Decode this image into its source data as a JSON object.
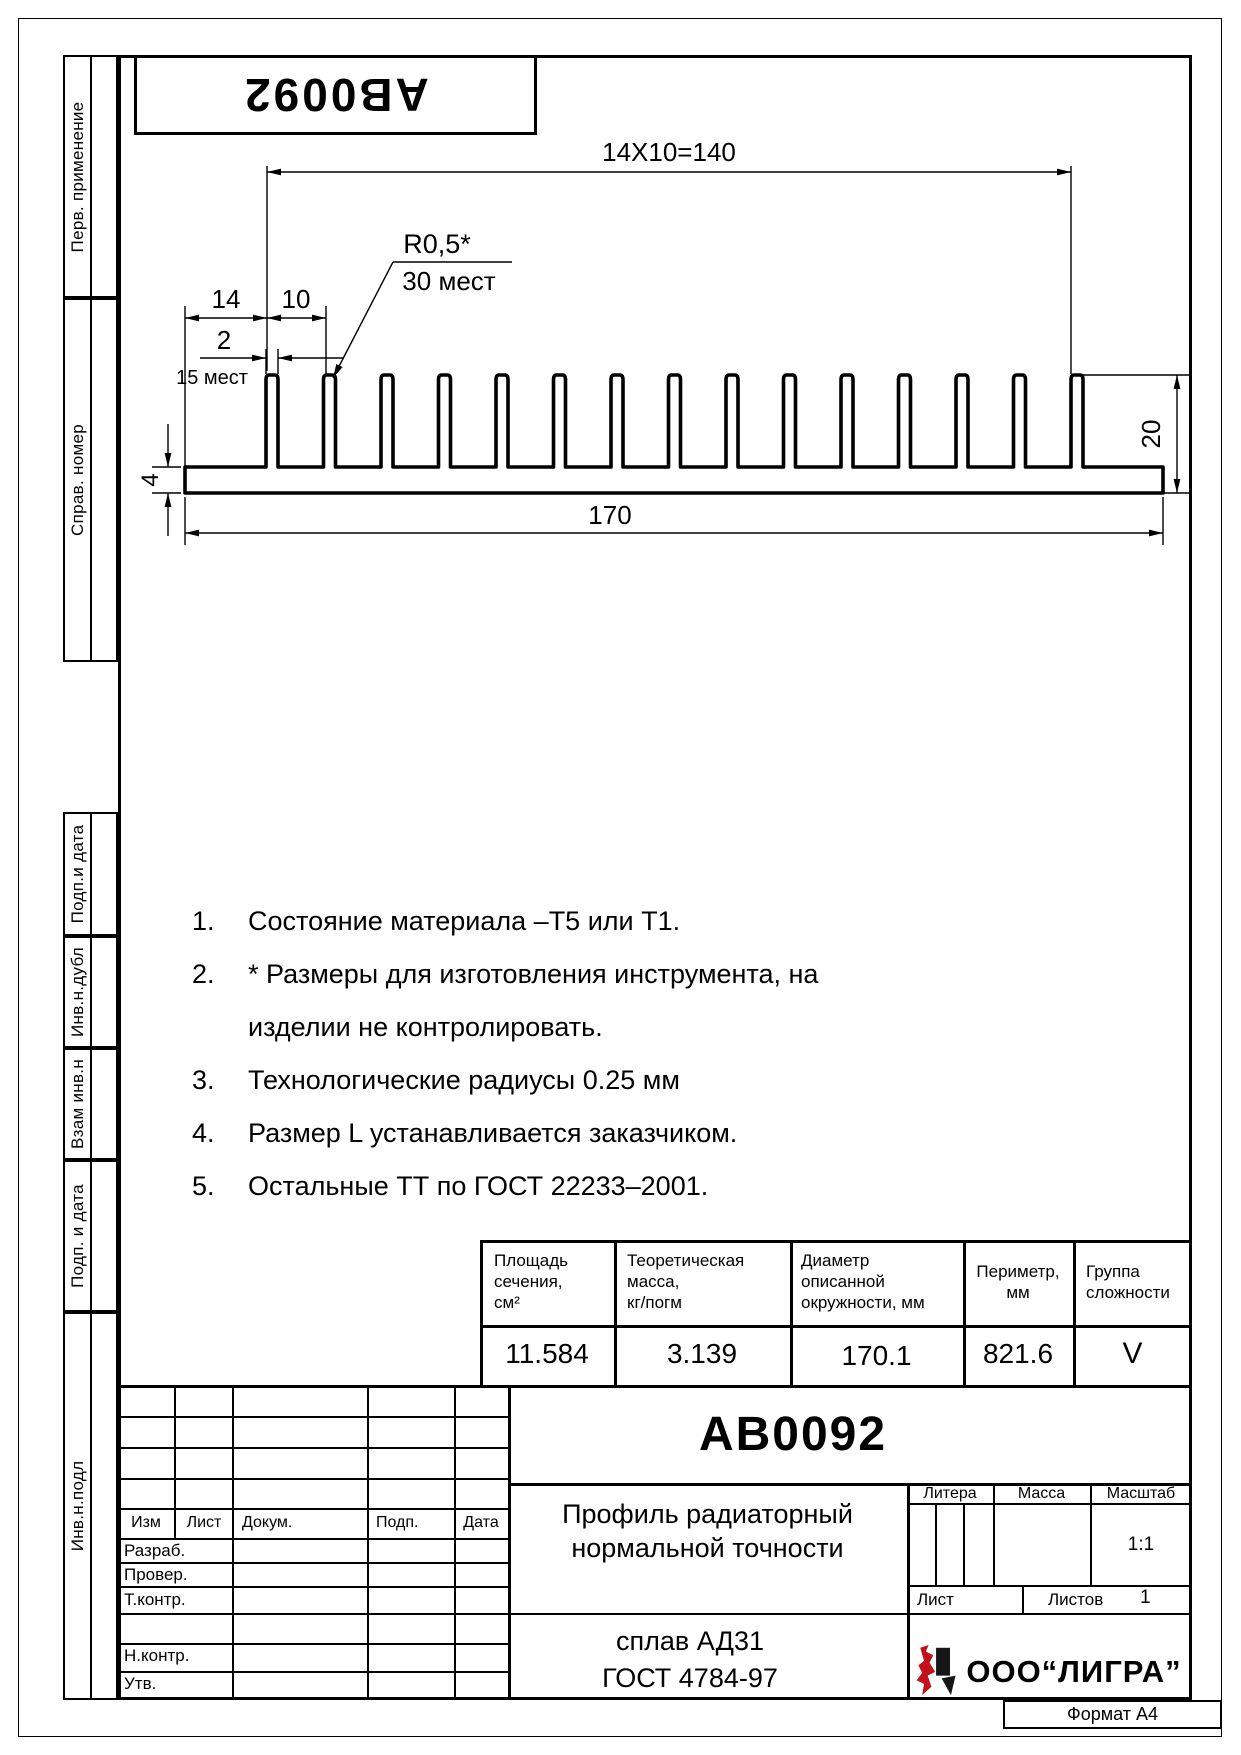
{
  "stamp": {
    "code": "АВ0092"
  },
  "margin": [
    "Перв. применение",
    "Справ. номер",
    "Подп.и дата",
    "Инв.н.дубл",
    "Взам инв.н",
    "Подп. и дата",
    "Инв.н.подл"
  ],
  "drawing": {
    "dims": {
      "pitch_total": "14X10=140",
      "radius": "R0,5*",
      "radius_places": "30 мест",
      "edge_offset": "14",
      "pitch": "10",
      "fin_width": "2",
      "fin_places": "15 мест",
      "width": "170",
      "height": "20",
      "base_thickness": "4"
    }
  },
  "notes": [
    {
      "num": "1.",
      "text": "Состояние материала –Т5 или Т1."
    },
    {
      "num": "2.",
      "text": "* Размеры для изготовления инструмента, на"
    },
    {
      "num": "",
      "text": "изделии не контролировать."
    },
    {
      "num": "3.",
      "text": "Технологические радиусы 0.25 мм"
    },
    {
      "num": "4.",
      "text": "Размер L устанавливается заказчиком."
    },
    {
      "num": "5.",
      "text": "Остальные ТТ по ГОСТ 22233–2001."
    }
  ],
  "params": {
    "headers": [
      [
        "Площадь",
        "сечения,",
        "см²"
      ],
      [
        "Теоретическая",
        "масса,",
        "кг/погм"
      ],
      [
        "Диаметр",
        "описанной",
        "окружности,  мм"
      ],
      [
        "Периметр,",
        "мм"
      ],
      [
        "Группа",
        "сложности"
      ]
    ],
    "values": [
      "11.584",
      "3.139",
      "170.1",
      "821.6",
      "V"
    ]
  },
  "title_block": {
    "doc_code": "АВ0092",
    "rev_headers": [
      "Изм",
      "Лист",
      "Докум.",
      "Подп.",
      "Дата"
    ],
    "sig_labels": [
      "Разраб.",
      "Провер.",
      "Т.контр.",
      "Н.контр.",
      "Утв."
    ],
    "name_line1": "Профиль радиаторный",
    "name_line2": "нормальной точности",
    "material_line1": "сплав АД31",
    "material_line2": "ГОСТ 4784-97",
    "litera_label": "Литера",
    "mass_label": "Масса",
    "scale_label": "Масштаб",
    "scale_value": "1:1",
    "sheet_label": "Лист",
    "sheets_label": "Листов",
    "sheets_value": "1",
    "company": "ООО“ЛИГРА”",
    "logo_color": "#c1121c"
  },
  "format_label": "Формат А4"
}
